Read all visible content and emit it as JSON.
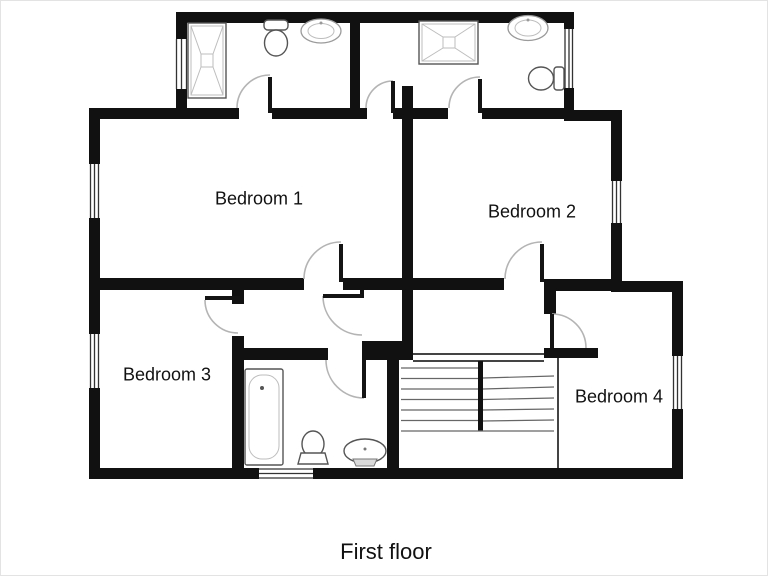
{
  "floorplan": {
    "caption": "First floor",
    "rooms": [
      {
        "name": "Bedroom 1"
      },
      {
        "name": "Bedroom 2"
      },
      {
        "name": "Bedroom 3"
      },
      {
        "name": "Bedroom 4"
      }
    ],
    "bathrooms": [
      {
        "position": "top-left-ensuite",
        "fixtures": [
          "shower",
          "toilet",
          "sink"
        ]
      },
      {
        "position": "top-right-ensuite",
        "fixtures": [
          "shower",
          "sink",
          "toilet"
        ]
      },
      {
        "position": "family-bathroom",
        "fixtures": [
          "bathtub",
          "toilet",
          "sink"
        ]
      }
    ],
    "features": {
      "stairs": "double-flight switchback",
      "windows": 7,
      "door_arcs": 9
    },
    "colors": {
      "wall": "#111111",
      "door_arc": "#b4b4b4",
      "fixture_line": "#555555",
      "background": "#ffffff",
      "text": "#111111"
    }
  }
}
